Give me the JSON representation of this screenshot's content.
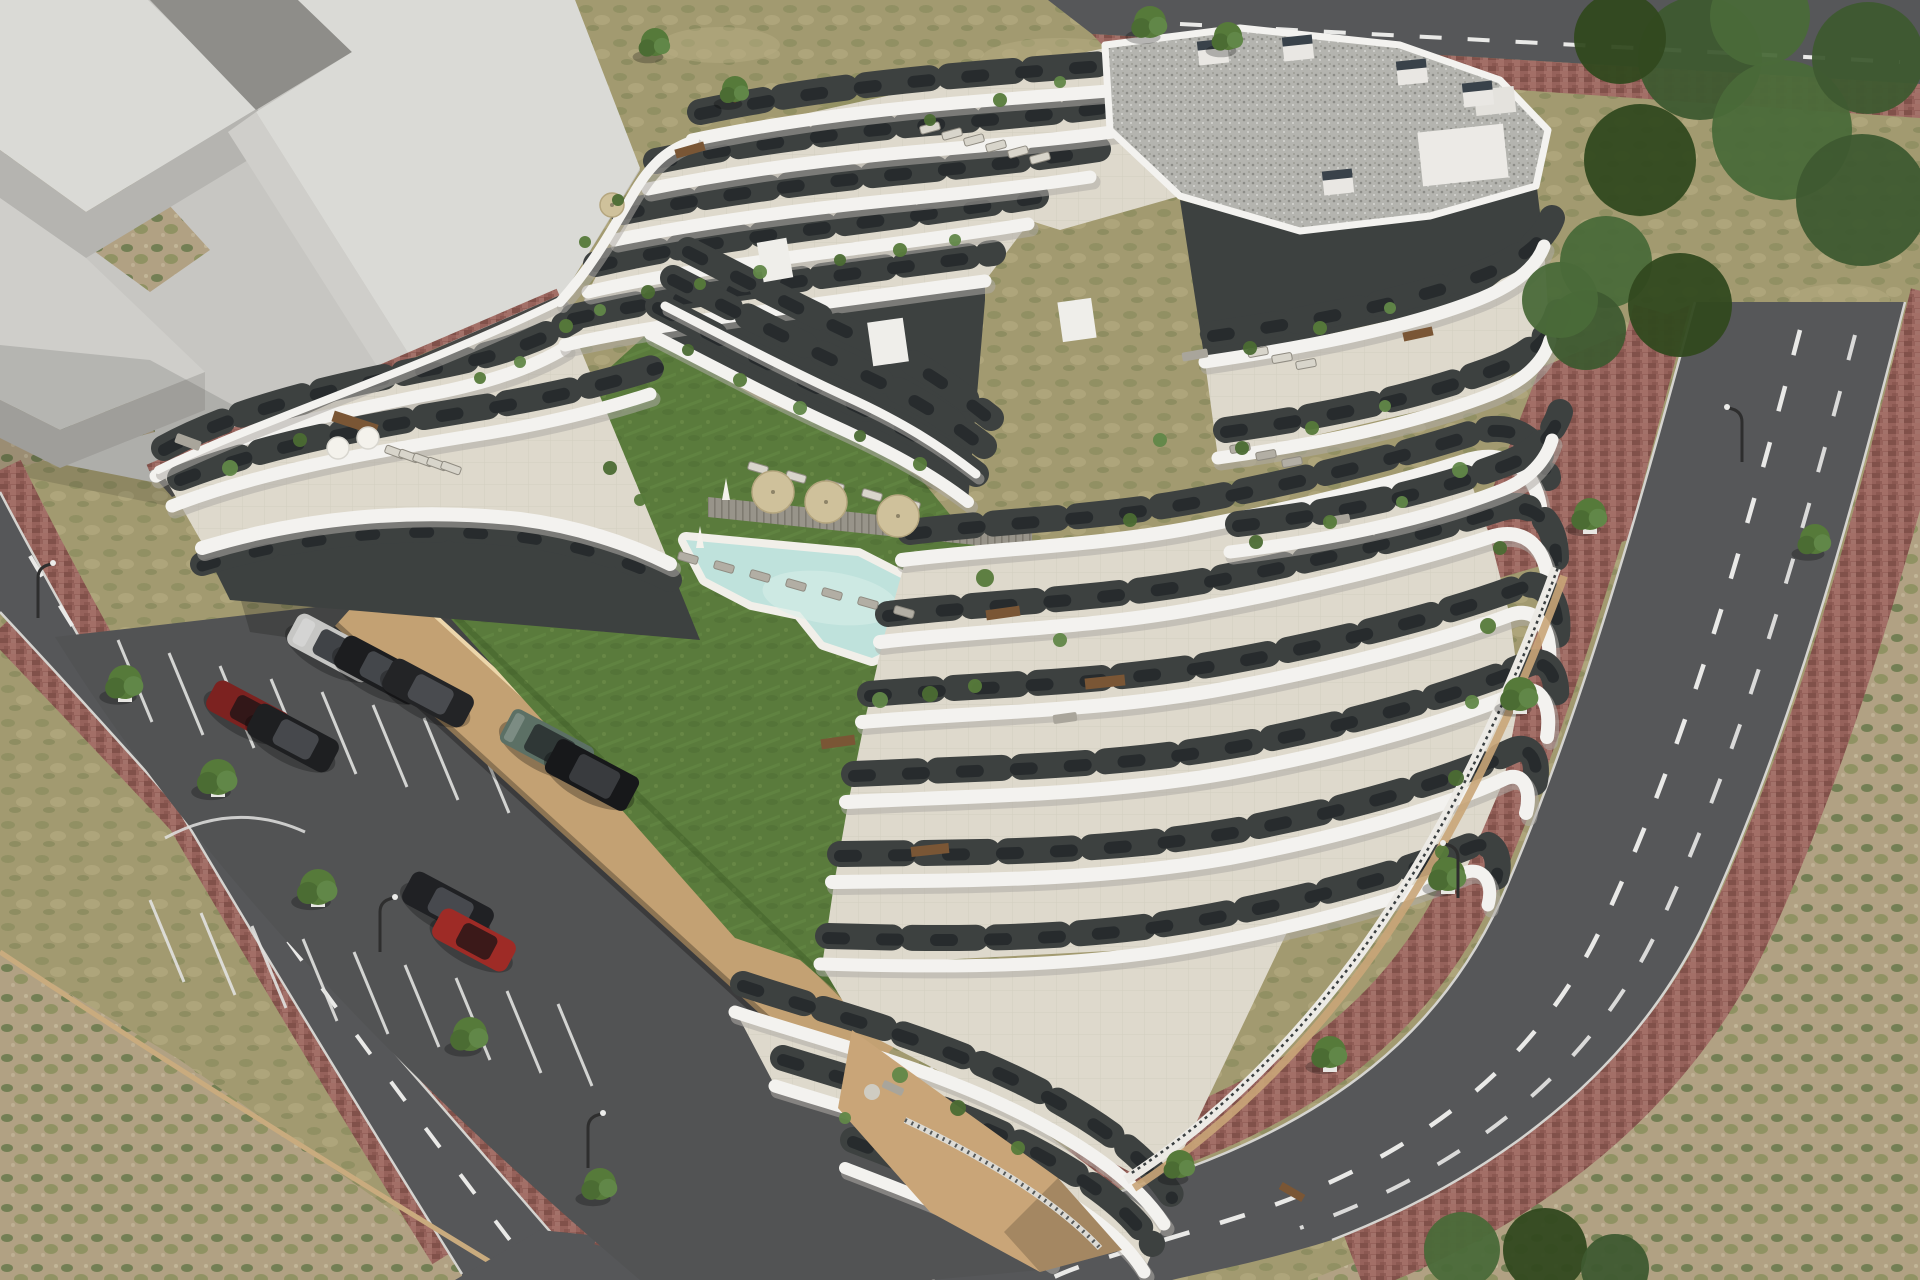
{
  "scene": {
    "type": "architectural-3d-render",
    "view": "aerial oblique",
    "description": "Photorealistic rendering of a modern white terraced apartment complex with wavy balcony bands and charcoal recesses, a central courtyard with lawn, freeform swimming pool, sun loungers, parasols and a playground, an open parking lot with cars, red-brick paved sidewalks, asphalt streets with dashed markings, street trees and lamp posts, a light gray massing model of a neighboring building at the top left, and dry scrubland around the site"
  },
  "colors": {
    "plaza": "#c7c6c2",
    "massing_top": "#dadad6",
    "massing_mid": "#cfceca",
    "massing_side": "#b5b4b0",
    "massing_dark": "#8e8d89",
    "dry_grass": "#a29a70",
    "dry_patch": "#858a58",
    "scrub_base": "#b1a183",
    "asphalt": "#565759",
    "road_dash": "#e9e9e7",
    "curb": "#d5d4d0",
    "brick_base": "#96625b",
    "parking_asphalt": "#525354",
    "parking_line": "#e2e2e0",
    "wall_tan": "#c3a173",
    "wall_tan_lit": "#ecd6ab",
    "podium_tan": "#c9a578",
    "building_white": "#f3f2ef",
    "band_shadow": "#aeaca6",
    "facade_charcoal": "#3d4140",
    "window_dark": "#23282a",
    "terrace_tile": "#ded9cc",
    "gravel_roof": "#b4b4af",
    "chimney_top": "#39424a",
    "lawn": "#5a7b3c",
    "lawn_light": "#688c46",
    "lawn_dark": "#4c6a31",
    "pool_water": "#bfe2dc",
    "pool_water_light": "#d8efe9",
    "pool_rim": "#f1efe9",
    "deck_wood": "#98948a",
    "parasol_tan": "#cfc19b",
    "parasol_white": "#f4f2ec",
    "lounger_light": "#d8d5cb",
    "lounger_dark": "#b2aea4",
    "playground_blue": "#4a74c2",
    "playground_red": "#c54338",
    "tree_green_a": "#567a3a",
    "tree_green_b": "#618748",
    "tree_green_c": "#4b6c33",
    "big_tree_a": "#3e5a30",
    "big_tree_b": "#4a6a39",
    "big_tree_c": "#32491f",
    "table_brown": "#7a5635",
    "sofa_gray": "#a9a59b",
    "fence_dark": "#3a3f40",
    "shadow": "rgba(20,22,20,0.24)"
  },
  "objects": {
    "context_building": "untextured light gray stepped massing blocks (neighboring plot)",
    "main_building": {
      "style": "white organic wavy balcony bands, charcoal recessed facades, cascading roof terraces",
      "floors_visible": 7,
      "roof": "flat gravel roof with chimneys and white roof boxes"
    },
    "courtyard": {
      "lawn": true,
      "pool": "freeform pool with white surround and wooden deck strip",
      "playground": "blue tower with red slide",
      "parasols_tan": 3,
      "sun_loungers": true
    },
    "parking": {
      "surface": "dark asphalt with white marked bays",
      "cars_parked": 9,
      "retaining_walls": "tan"
    },
    "streets": {
      "sidewalks": "red clay brick pavers",
      "markings": "white dashed center lines",
      "street_trees": 15,
      "lamp_posts": 5
    }
  },
  "cars": [
    {
      "label": "silver sedan",
      "color": "#c6c6c4"
    },
    {
      "label": "black sedan",
      "color": "#1c1d1f"
    },
    {
      "label": "black sedan",
      "color": "#232426"
    },
    {
      "label": "dark red hatchback",
      "color": "#7c2220"
    },
    {
      "label": "black sedan",
      "color": "#1e1f21"
    },
    {
      "label": "green suv",
      "color": "#5c7065"
    },
    {
      "label": "black suv",
      "color": "#17181a"
    },
    {
      "label": "black sedan",
      "color": "#202124"
    },
    {
      "label": "dark red hatchback",
      "color": "#9e2b26"
    }
  ]
}
